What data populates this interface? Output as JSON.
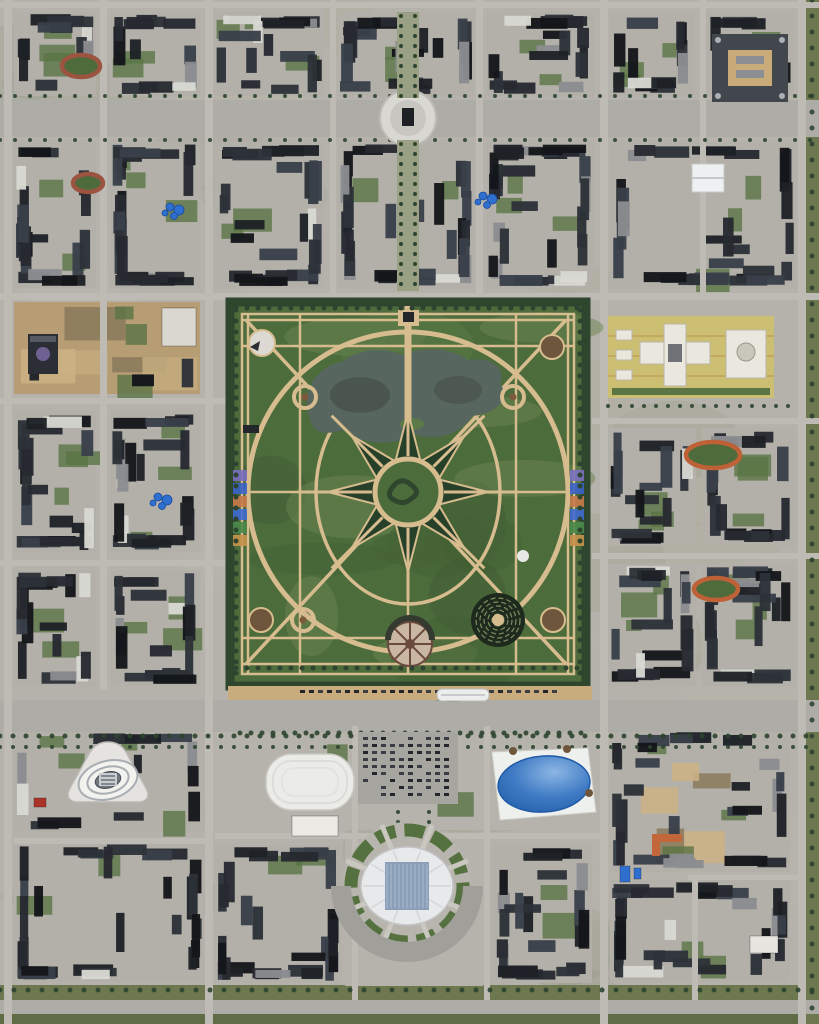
{
  "meta": {
    "alt": "aerial-satellite-view-planned-city-with-grand-circular-park"
  },
  "scene": {
    "size": {
      "w": 819,
      "h": 1024
    },
    "palette": {
      "ground": "#b4b2aa",
      "block": "#b2b0a8",
      "road": "#bdbbb4",
      "blvd": "#aeaca6",
      "dirt": "#b79d74",
      "grass": "#5a7445",
      "tree": "#2e4430",
      "parkGreen": "#4d6c3c",
      "parkDark": "#2e462e",
      "path": "#d6bc8e",
      "star": "#27402a",
      "lake": "#57665e",
      "lakeDark": "#454f4a",
      "tan": "#c8ac7d",
      "buildings": [
        "#1e2127",
        "#262a30",
        "#2d3238",
        "#394049",
        "#14161a"
      ],
      "white": "#e9e8e4",
      "blue": "#2e6fd0",
      "greenVerge": "#6d7850"
    },
    "roads": {
      "h": [
        [
          0,
          2,
          819,
          6,
          0
        ],
        [
          0,
          100,
          819,
          37,
          1
        ],
        [
          0,
          293,
          819,
          7,
          0
        ],
        [
          0,
          398,
          228,
          6,
          0
        ],
        [
          592,
          418,
          227,
          6,
          0
        ],
        [
          0,
          560,
          228,
          6,
          0
        ],
        [
          592,
          553,
          227,
          6,
          0
        ],
        [
          0,
          700,
          819,
          32,
          1
        ],
        [
          215,
          833,
          385,
          6,
          0
        ],
        [
          14,
          838,
          196,
          6,
          0
        ],
        [
          688,
          875,
          117,
          5,
          0
        ],
        [
          0,
          1000,
          819,
          14,
          1
        ]
      ],
      "v": [
        [
          4,
          0,
          8,
          1024
        ],
        [
          100,
          0,
          7,
          690
        ],
        [
          205,
          0,
          8,
          1024
        ],
        [
          330,
          0,
          6,
          293
        ],
        [
          476,
          0,
          7,
          293
        ],
        [
          700,
          0,
          6,
          293
        ],
        [
          600,
          0,
          8,
          1024
        ],
        [
          798,
          0,
          8,
          1024
        ],
        [
          352,
          726,
          6,
          274
        ],
        [
          484,
          726,
          6,
          274
        ],
        [
          692,
          880,
          6,
          120
        ]
      ]
    },
    "greens": [
      [
        0,
        985,
        819,
        15,
        "#6d7850"
      ],
      [
        0,
        1014,
        819,
        10,
        "#5f6c46"
      ],
      [
        806,
        0,
        13,
        1024,
        "#6d7850"
      ]
    ],
    "blocks": [
      [
        14,
        12,
        82,
        84,
        11,
        ""
      ],
      [
        110,
        12,
        90,
        84,
        12,
        ""
      ],
      [
        214,
        12,
        110,
        84,
        13,
        ""
      ],
      [
        338,
        12,
        136,
        84,
        14,
        ""
      ],
      [
        486,
        12,
        108,
        84,
        15,
        ""
      ],
      [
        610,
        12,
        84,
        84,
        16,
        ""
      ],
      [
        706,
        12,
        88,
        84,
        17,
        ""
      ],
      [
        14,
        142,
        82,
        146,
        21,
        ""
      ],
      [
        110,
        142,
        90,
        146,
        22,
        ""
      ],
      [
        214,
        142,
        110,
        146,
        23,
        ""
      ],
      [
        338,
        142,
        136,
        146,
        24,
        ""
      ],
      [
        486,
        142,
        108,
        146,
        25,
        ""
      ],
      [
        610,
        142,
        186,
        146,
        26,
        ""
      ],
      [
        14,
        302,
        186,
        92,
        31,
        "dirt"
      ],
      [
        14,
        410,
        82,
        142,
        33,
        ""
      ],
      [
        110,
        410,
        90,
        142,
        34,
        ""
      ],
      [
        14,
        570,
        82,
        116,
        35,
        ""
      ],
      [
        110,
        570,
        90,
        116,
        36,
        ""
      ],
      [
        608,
        428,
        88,
        118,
        41,
        ""
      ],
      [
        702,
        428,
        94,
        118,
        42,
        ""
      ],
      [
        608,
        564,
        88,
        122,
        43,
        ""
      ],
      [
        702,
        564,
        94,
        122,
        44,
        ""
      ],
      [
        14,
        728,
        190,
        104,
        51,
        "campus"
      ],
      [
        14,
        842,
        190,
        140,
        52,
        ""
      ],
      [
        212,
        726,
        392,
        104,
        60,
        "plaza"
      ],
      [
        345,
        836,
        138,
        150,
        61,
        "plaza"
      ],
      [
        215,
        845,
        126,
        138,
        53,
        ""
      ],
      [
        492,
        845,
        100,
        138,
        54,
        ""
      ],
      [
        610,
        728,
        180,
        144,
        55,
        "dirt2"
      ],
      [
        610,
        880,
        180,
        102,
        56,
        ""
      ]
    ],
    "treeRows": [
      {
        "x": 0,
        "y": 96,
        "len": 819,
        "dir": "h",
        "step": 15,
        "s": 4
      },
      {
        "x": 0,
        "y": 140,
        "len": 819,
        "dir": "h",
        "step": 15,
        "s": 4
      },
      {
        "x": 0,
        "y": 736,
        "len": 819,
        "dir": "h",
        "step": 13,
        "s": 5
      },
      {
        "x": 0,
        "y": 747,
        "len": 819,
        "dir": "h",
        "step": 13,
        "s": 4
      },
      {
        "x": 0,
        "y": 990,
        "len": 819,
        "dir": "h",
        "step": 14,
        "s": 5
      },
      {
        "x": 812,
        "y": 0,
        "len": 1024,
        "dir": "v",
        "step": 16,
        "s": 5
      },
      {
        "x": 608,
        "y": 406,
        "len": 192,
        "dir": "h",
        "step": 12,
        "s": 4
      },
      {
        "x": 398,
        "y": 752,
        "len": 86,
        "dir": "v",
        "step": 10,
        "s": 4
      },
      {
        "x": 429,
        "y": 752,
        "len": 86,
        "dir": "v",
        "step": 10,
        "s": 4
      },
      {
        "x": 240,
        "y": 733,
        "len": 350,
        "dir": "h",
        "step": 11,
        "s": 5
      }
    ],
    "park": {
      "x": 228,
      "y": 300,
      "w": 360,
      "h": 388,
      "cx": 408,
      "cy": 492,
      "ringR": 160,
      "ellipse": [
        92,
        112
      ],
      "star": {
        "R": 80,
        "r": 33
      },
      "centerR": 33,
      "gridV": [
        248,
        300,
        408,
        516,
        568
      ],
      "gridH": [
        320,
        346,
        492,
        638,
        664
      ],
      "inset": [
        242,
        314,
        332,
        360
      ],
      "rings": [
        [
          305,
          397
        ],
        [
          513,
          397
        ],
        [
          303,
          620
        ]
      ],
      "pads": [
        [
          552,
          347
        ],
        [
          261,
          620
        ],
        [
          553,
          620
        ]
      ],
      "whitePad": [
        262,
        343
      ],
      "maze": [
        498,
        620,
        27
      ],
      "wheel": [
        410,
        644,
        22
      ],
      "pond": [
        523,
        556,
        6
      ],
      "flowersLeft": {
        "x": 233,
        "y": 470
      },
      "flowersRight": {
        "x": 570,
        "y": 470
      },
      "flowerColors": [
        "#7a6fc0",
        "#3a62c8",
        "#c87a4a",
        "#3f6ad0",
        "#4a8a4a",
        "#c8924a"
      ],
      "building": [
        243,
        425,
        16,
        8
      ],
      "tanStrip": [
        228,
        686,
        364,
        14
      ]
    },
    "landmarks": [
      {
        "kind": "roundabout",
        "name": "roundabout-plaza",
        "cx": 408,
        "cy": 118,
        "r": 28
      },
      {
        "kind": "axis",
        "name": "north-axis-strip",
        "x": 397,
        "y": 12,
        "w": 22,
        "h": 86
      },
      {
        "kind": "axis",
        "name": "plaza-axis-strip",
        "x": 397,
        "y": 140,
        "w": 22,
        "h": 151
      },
      {
        "kind": "courtyard",
        "name": "courtyard-building",
        "x": 712,
        "y": 34,
        "w": 76,
        "h": 68
      },
      {
        "kind": "tent",
        "name": "white-hall",
        "x": 692,
        "y": 164,
        "w": 32,
        "h": 28
      },
      {
        "kind": "track",
        "name": "running-track",
        "cx": 81,
        "cy": 66,
        "rx": 19,
        "ry": 11,
        "c": "#9c5340"
      },
      {
        "kind": "track",
        "name": "running-track",
        "cx": 88,
        "cy": 183,
        "rx": 15,
        "ry": 9,
        "c": "#9c5340"
      },
      {
        "kind": "track",
        "name": "running-track",
        "cx": 713,
        "cy": 455,
        "rx": 27,
        "ry": 13,
        "c": "#bf6136"
      },
      {
        "kind": "track",
        "name": "running-track",
        "cx": 716,
        "cy": 589,
        "rx": 22,
        "ry": 11,
        "c": "#bf6136"
      },
      {
        "kind": "tarps",
        "name": "blue-tarps",
        "cx": 483,
        "cy": 196
      },
      {
        "kind": "tarps",
        "name": "blue-tarps",
        "cx": 170,
        "cy": 207
      },
      {
        "kind": "tarps",
        "name": "blue-tarps",
        "cx": 158,
        "cy": 497
      },
      {
        "kind": "domebldg",
        "name": "dark-dome-building",
        "x": 28,
        "y": 334
      },
      {
        "kind": "rect",
        "name": "white-building",
        "x": 162,
        "y": 308,
        "w": 34,
        "h": 38,
        "c": "#d9d7d0"
      },
      {
        "kind": "museum",
        "name": "spiral-museum",
        "cx": 108,
        "cy": 778
      },
      {
        "kind": "dome",
        "name": "white-dome-hall",
        "x": 266,
        "y": 754,
        "w": 88,
        "h": 56
      },
      {
        "kind": "rect",
        "name": "exhibition-hall",
        "x": 292,
        "y": 816,
        "w": 46,
        "h": 20,
        "c": "#eceae4"
      },
      {
        "kind": "parking",
        "name": "parking-lot",
        "x": 358,
        "y": 732,
        "w": 100,
        "h": 72
      },
      {
        "kind": "egg",
        "name": "blue-dome-hall",
        "cx": 544,
        "cy": 784
      },
      {
        "kind": "stadium",
        "name": "stadium",
        "cx": 407,
        "cy": 886
      },
      {
        "kind": "train",
        "name": "white-train",
        "x": 437,
        "y": 689,
        "w": 52,
        "h": 12
      },
      {
        "kind": "campus",
        "name": "government-campus",
        "x": 608,
        "y": 316,
        "w": 166,
        "h": 82
      },
      {
        "kind": "orange",
        "name": "orange-building",
        "x": 652,
        "y": 834
      },
      {
        "kind": "rect",
        "name": "white-building",
        "x": 750,
        "y": 936,
        "w": 28,
        "h": 17,
        "c": "#e6e5e0"
      },
      {
        "kind": "rect",
        "name": "blue-panel",
        "x": 620,
        "y": 866,
        "w": 10,
        "h": 16,
        "c": "#2e6fd0"
      },
      {
        "kind": "rect",
        "name": "blue-panel",
        "x": 634,
        "y": 868,
        "w": 7,
        "h": 11,
        "c": "#2e6fd0"
      },
      {
        "kind": "rect",
        "name": "red-roof-building",
        "x": 34,
        "y": 798,
        "w": 12,
        "h": 9,
        "c": "#ab3526"
      }
    ]
  }
}
